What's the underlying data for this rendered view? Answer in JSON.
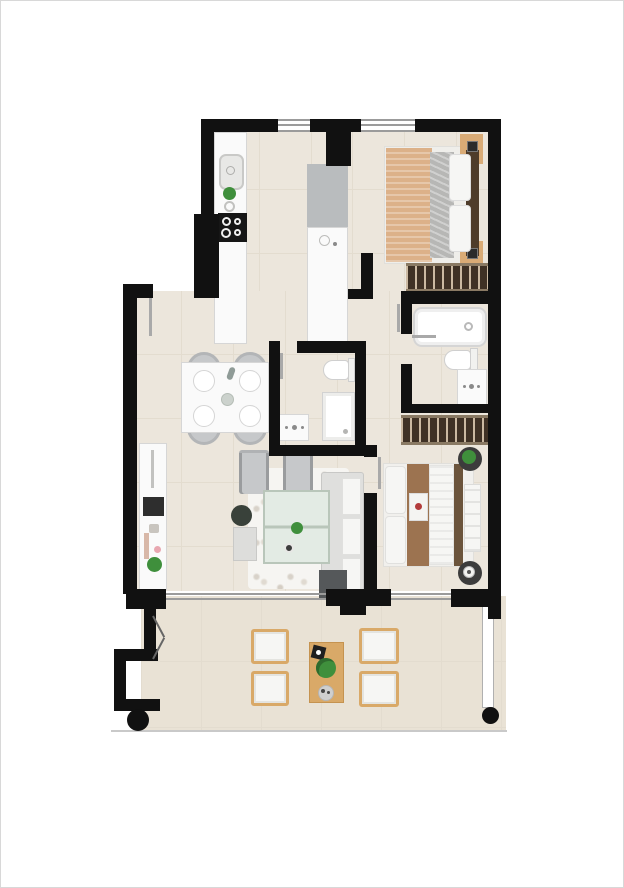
{
  "document": {
    "type": "apartment-floor-plan",
    "description": "Top-down rendered floor plan of a two-bedroom apartment with terrace; no text labels rendered"
  },
  "colors": {
    "wall": "#111111",
    "frame": "#d8d8d8",
    "floor": "#ece6dc",
    "floor_line": "#e3dccf",
    "terrace_floor": "#e9e2d5",
    "white_fixture": "#fafafa",
    "fixture_border": "#d6d6d6",
    "glass_line": "#9b9b9b",
    "gray_appliance": "#b9bcbe",
    "cooktop": "#161616",
    "wood": "#d9ab76",
    "wood_terrace": "#d9a968",
    "wardrobe_dark": "#3f3125",
    "wardrobe_rail": "#8a7a64",
    "wardrobe_line": "#cbb9a2",
    "headboard_dark": "#4e3c2a",
    "headboard2": "#6b543c",
    "bed_tan": "#dcb189",
    "blanket_gray": "#b7b7b5",
    "bed_brown": "#9c7350",
    "sofa_gray": "#dfdfdd",
    "cushion_white": "#f6f6f4",
    "charcoal": "#55585a",
    "chair_gray": "#c6c8ca",
    "rug": "#f6f5f2",
    "rug_speckle": "#d8d2c9",
    "glass_table": "#e3ebe4",
    "glass_table_border": "#b9c6ba",
    "plant_green": "#3f8f3c",
    "plant_dark": "#39413a",
    "flower_red": "#b23b3b",
    "flower_pink": "#e8a7b0",
    "door_leaf": "#a9a9a9"
  },
  "rooms": {
    "kitchen": {
      "name": "Kitchen",
      "furniture": [
        "counter",
        "sink",
        "faucet",
        "plant",
        "cooktop",
        "tall-units",
        "island-counter"
      ]
    },
    "bedroom1": {
      "name": "Bedroom 1",
      "furniture": [
        "double-bed",
        "pillows",
        "throw-blanket",
        "headboard",
        "nightstand-left",
        "nightstand-right",
        "wardrobe"
      ]
    },
    "bathroom1": {
      "name": "Bathroom 1",
      "furniture": [
        "bathtub",
        "toilet",
        "vanity-sink"
      ]
    },
    "bathroom2": {
      "name": "Bathroom 2",
      "furniture": [
        "toilet",
        "shower",
        "vanity-sink"
      ]
    },
    "dining": {
      "name": "Dining area",
      "furniture": [
        "table",
        "chairs-x4",
        "plates-x4",
        "bottle",
        "centerpiece"
      ]
    },
    "living": {
      "name": "Living room",
      "furniture": [
        "sideboard",
        "tv",
        "plant",
        "armchair-x2",
        "rug",
        "glass-coffee-table",
        "side-table",
        "dark-plant",
        "sofa",
        "ottoman"
      ]
    },
    "bedroom2": {
      "name": "Bedroom 2",
      "furniture": [
        "wardrobe",
        "double-bed",
        "pillows",
        "brown-runner",
        "flower-cushion",
        "bench",
        "round-nightstand-x2"
      ]
    },
    "terrace": {
      "name": "Terrace",
      "furniture": [
        "lounge-chair-x4",
        "wood-table",
        "plant",
        "trays",
        "storage-niche",
        "column-x2",
        "glass-balustrade"
      ]
    }
  },
  "openings": {
    "windows": [
      "kitchen-window",
      "bedroom1-window"
    ],
    "doors": [
      "entrance-door",
      "bedroom1-door",
      "bathroom2-door",
      "bathroom1-door",
      "bedroom2-door",
      "terrace-niche-door"
    ],
    "sliding_doors": [
      "living-terrace-slider",
      "bedroom2-terrace-slider"
    ]
  }
}
